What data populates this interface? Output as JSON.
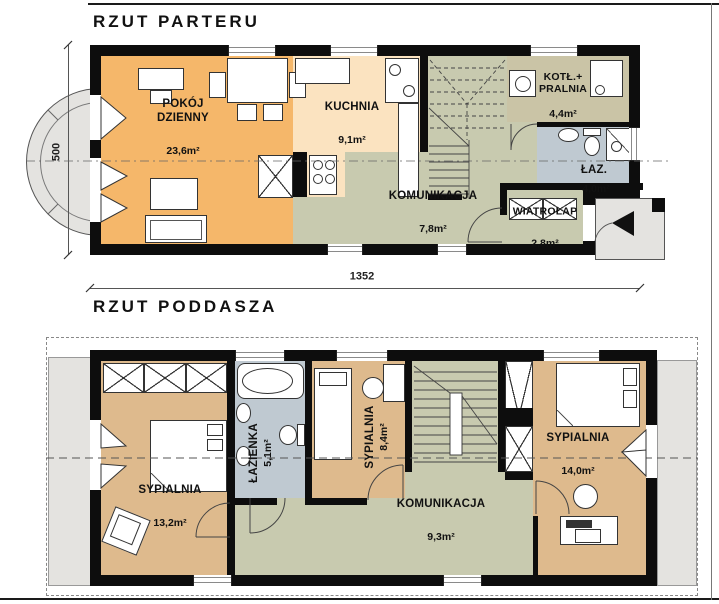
{
  "drawing": {
    "ground_floor": {
      "title": "RZUT PARTERU",
      "rooms": {
        "living": {
          "name": "POKÓJ\nDZIENNY",
          "area": "23,6m²"
        },
        "kitchen": {
          "name": "KUCHNIA",
          "area": "9,1m²"
        },
        "boiler_laundry": {
          "name": "KOTŁ.+\nPRALNIA",
          "area": "4,4m²"
        },
        "bathroom": {
          "name": "ŁAZ.",
          "area": "4,0m²"
        },
        "hall": {
          "name": "KOMUNIKACJA",
          "area": "7,8m²"
        },
        "vestibule": {
          "name": "WIATROŁAP",
          "area": "2,8m²"
        }
      },
      "dimensions": {
        "depth": "500",
        "width": "1352"
      }
    },
    "attic_floor": {
      "title": "RZUT PODDASZA",
      "rooms": {
        "bedroom1": {
          "name": "SYPIALNIA",
          "area": "13,2m²"
        },
        "bathroom": {
          "name": "ŁAZIENKA",
          "area": "5,1m²"
        },
        "bedroom2": {
          "name": "SYPIALNIA",
          "area": "8,4m²"
        },
        "bedroom3": {
          "name": "SYPIALNIA",
          "area": "14,0m²"
        },
        "hall": {
          "name": "KOMUNIKACJA",
          "area": "9,3m²"
        }
      }
    }
  },
  "colors": {
    "living": "#F5B76A",
    "kitchen": "#FBE3C0",
    "hall": "#C8CAAF",
    "utility": "#CAC4A6",
    "bath": "#BFC9D1",
    "bedroom": "#DEBA8D",
    "terrace": "#E4E3E0",
    "wall": "#0D0D0D"
  }
}
